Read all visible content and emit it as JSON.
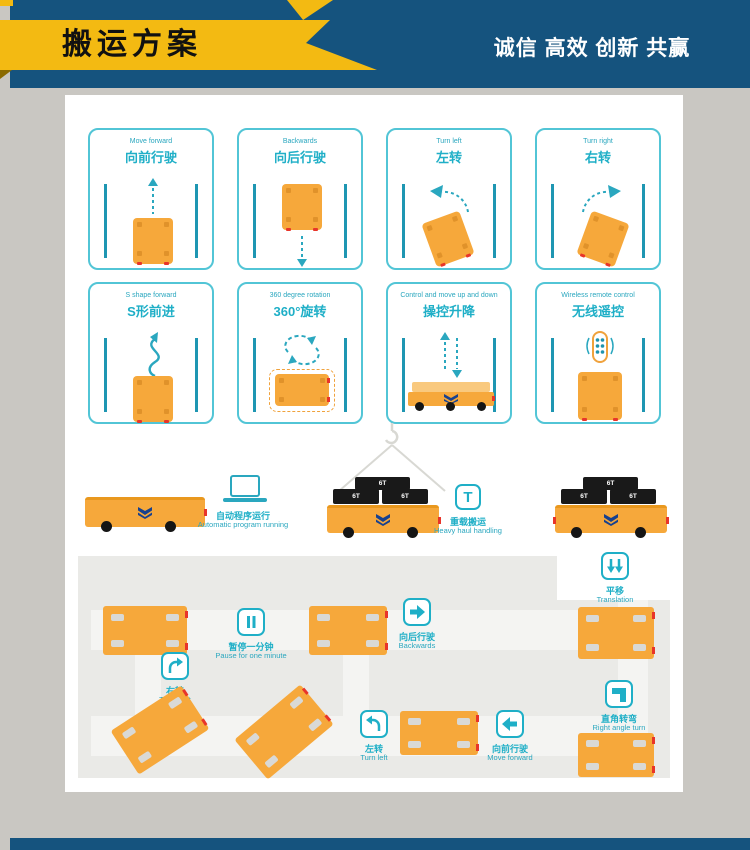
{
  "header": {
    "title": "搬运方案",
    "slogan": "诚信 高效 创新 共赢"
  },
  "cards": [
    {
      "en": "Move forward",
      "zh": "向前行驶"
    },
    {
      "en": "Backwards",
      "zh": "向后行驶"
    },
    {
      "en": "Turn left",
      "zh": "左转"
    },
    {
      "en": "Turn right",
      "zh": "右转"
    },
    {
      "en": "S shape forward",
      "zh": "S形前进"
    },
    {
      "en": "360 degree rotation",
      "zh": "360°旋转"
    },
    {
      "en": "Control and move up and down",
      "zh": "操控升降"
    },
    {
      "en": "Wireless remote control",
      "zh": "无线遥控"
    }
  ],
  "middle": {
    "auto_run": {
      "zh": "自动程序运行",
      "en": "Automatic program running"
    },
    "heavy_haul": {
      "zh": "重载搬运",
      "en": "Heavy haul handling",
      "icon_letter": "T"
    },
    "cargo_label": "6T"
  },
  "path": {
    "pause": {
      "zh": "暂停一分钟",
      "en": "Pause for one minute"
    },
    "backwards": {
      "zh": "向后行驶",
      "en": "Backwards"
    },
    "translation": {
      "zh": "平移",
      "en": "Translation"
    },
    "turn_right": {
      "zh": "右转",
      "en": "Turn right"
    },
    "turn_left": {
      "zh": "左转",
      "en": "Turn left"
    },
    "move_forward": {
      "zh": "向前行驶",
      "en": "Move forward"
    },
    "right_angle": {
      "zh": "直角转弯",
      "en": "Right angle turn"
    }
  },
  "colors": {
    "header_blue": "#15537E",
    "banner_yellow": "#F3BA12",
    "teal": "#1FAFC7",
    "rail_teal": "#1E96B2",
    "vehicle_orange": "#F6A83B",
    "marker_red": "#E8352A",
    "path_gray": "#EAEAE7",
    "road_gray": "#F4F4F2"
  }
}
